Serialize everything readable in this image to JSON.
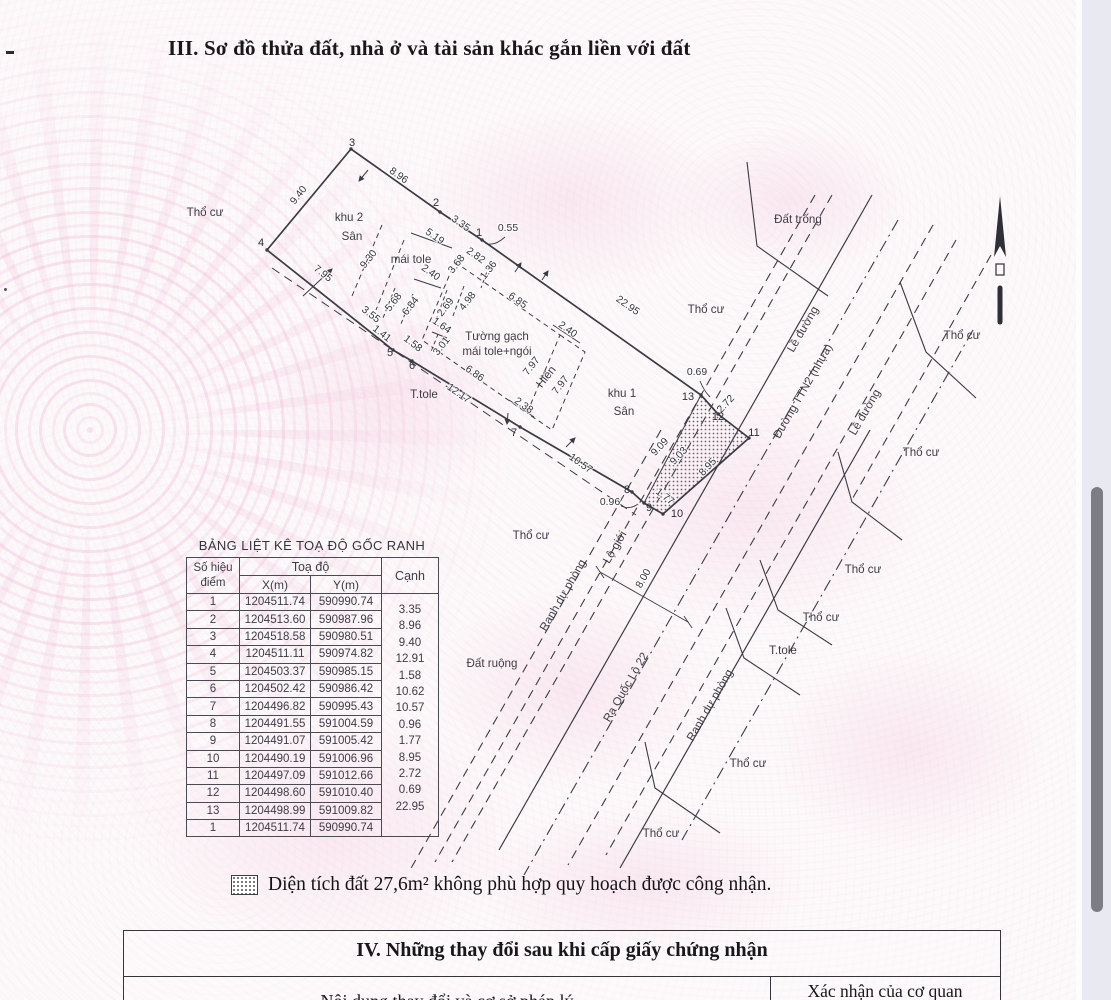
{
  "page": {
    "section3_title": "III. Sơ đồ thửa đất, nhà ở và tài sản khác gắn liền với đất",
    "legend_note": "Diện tích đất 27,6m² không phù hợp quy hoạch được công nhận.",
    "section4_title": "IV. Những thay đổi sau khi cấp giấy chứng nhận",
    "section4_col_left": "Nội dung thay đổi và cơ sở pháp lý",
    "section4_col_right": "Xác nhận của cơ quan"
  },
  "table": {
    "title": "BẢNG LIỆT KÊ TOẠ ĐỘ GỐC RANH",
    "col_point_l1": "Số hiệu",
    "col_point_l2": "điểm",
    "col_coord": "Toạ độ",
    "col_x": "X(m)",
    "col_y": "Y(m)",
    "col_edge": "Cạnh",
    "rows": [
      [
        "1",
        "1204511.74",
        "590990.74"
      ],
      [
        "2",
        "1204513.60",
        "590987.96"
      ],
      [
        "3",
        "1204518.58",
        "590980.51"
      ],
      [
        "4",
        "1204511.11",
        "590974.82"
      ],
      [
        "5",
        "1204503.37",
        "590985.15"
      ],
      [
        "6",
        "1204502.42",
        "590986.42"
      ],
      [
        "7",
        "1204496.82",
        "590995.43"
      ],
      [
        "8",
        "1204491.55",
        "591004.59"
      ],
      [
        "9",
        "1204491.07",
        "591005.42"
      ],
      [
        "10",
        "1204490.19",
        "591006.96"
      ],
      [
        "11",
        "1204497.09",
        "591012.66"
      ],
      [
        "12",
        "1204498.60",
        "591010.40"
      ],
      [
        "13",
        "1204498.99",
        "591009.82"
      ],
      [
        "1",
        "1204511.74",
        "590990.74"
      ]
    ],
    "edges": [
      "3.35",
      "8.96",
      "9.40",
      "12.91",
      "1.58",
      "10.62",
      "10.57",
      "0.96",
      "1.77",
      "8.95",
      "2.72",
      "0.69",
      "22.95"
    ]
  },
  "map": {
    "area_labels": [
      {
        "t": "Thổ cư",
        "x": 205,
        "y": 216
      },
      {
        "t": "khu 2",
        "x": 349,
        "y": 221
      },
      {
        "t": "Sân",
        "x": 352,
        "y": 240
      },
      {
        "t": "mái tole",
        "x": 411,
        "y": 263
      },
      {
        "t": "Tường gạch",
        "x": 497,
        "y": 340
      },
      {
        "t": "mái tole+ngói",
        "x": 497,
        "y": 355
      },
      {
        "t": "khu 1",
        "x": 622,
        "y": 397
      },
      {
        "t": "Sân",
        "x": 624,
        "y": 415
      },
      {
        "t": "T.tole",
        "x": 424,
        "y": 398
      },
      {
        "t": "Hiên",
        "x": 549,
        "y": 379,
        "r": -52
      },
      {
        "t": "Đất trống",
        "x": 798,
        "y": 223
      },
      {
        "t": "Thổ cư",
        "x": 706,
        "y": 313
      },
      {
        "t": "Thổ cư",
        "x": 962,
        "y": 339
      },
      {
        "t": "Thổ cư",
        "x": 921,
        "y": 456
      },
      {
        "t": "Thổ cư",
        "x": 863,
        "y": 573
      },
      {
        "t": "Thổ cư",
        "x": 821,
        "y": 621
      },
      {
        "t": "T.tole",
        "x": 783,
        "y": 654
      },
      {
        "t": "Thổ cư",
        "x": 748,
        "y": 767
      },
      {
        "t": "Thổ cư",
        "x": 661,
        "y": 837
      },
      {
        "t": "Thổ cư",
        "x": 531,
        "y": 539
      },
      {
        "t": "Đất ruộng",
        "x": 492,
        "y": 667
      },
      {
        "t": "Lề đường",
        "x": 806,
        "y": 331,
        "r": -60
      },
      {
        "t": "Lề đường",
        "x": 868,
        "y": 414,
        "r": -60
      },
      {
        "t": "Đường TTN2 (nhựa)",
        "x": 806,
        "y": 393,
        "r": -60
      },
      {
        "t": "Lộ giới",
        "x": 618,
        "y": 549,
        "r": -60
      },
      {
        "t": "Ranh dự phòng",
        "x": 566,
        "y": 597,
        "r": -60
      },
      {
        "t": "Ranh dự phòng",
        "x": 713,
        "y": 707,
        "r": -60
      },
      {
        "t": "Ra Quốc Lộ 22",
        "x": 629,
        "y": 689,
        "r": -60
      }
    ],
    "dim_labels": [
      {
        "t": "8.96",
        "x": 397,
        "y": 178,
        "r": 35
      },
      {
        "t": "3.35",
        "x": 459,
        "y": 226,
        "r": 35
      },
      {
        "t": "0.55",
        "x": 508,
        "y": 231
      },
      {
        "t": "9.40",
        "x": 301,
        "y": 197,
        "r": -52
      },
      {
        "t": "5.19",
        "x": 433,
        "y": 239,
        "r": 35
      },
      {
        "t": "9.30",
        "x": 371,
        "y": 261,
        "r": -52
      },
      {
        "t": "7.95",
        "x": 321,
        "y": 276,
        "r": 38
      },
      {
        "t": "2.40",
        "x": 429,
        "y": 275,
        "r": 35
      },
      {
        "t": "3.55",
        "x": 369,
        "y": 317,
        "r": 38
      },
      {
        "t": "1.41",
        "x": 380,
        "y": 336,
        "r": 38
      },
      {
        "t": "1.58",
        "x": 411,
        "y": 346,
        "r": 38
      },
      {
        "t": "5.68",
        "x": 396,
        "y": 304,
        "r": -52
      },
      {
        "t": "6.84",
        "x": 413,
        "y": 308,
        "r": -52
      },
      {
        "t": "2.69",
        "x": 448,
        "y": 309,
        "r": -52
      },
      {
        "t": "1.64",
        "x": 440,
        "y": 328,
        "r": 35
      },
      {
        "t": "3.01",
        "x": 444,
        "y": 348,
        "r": -52
      },
      {
        "t": "3.68",
        "x": 459,
        "y": 266,
        "r": -52
      },
      {
        "t": "2.82",
        "x": 474,
        "y": 258,
        "r": 35
      },
      {
        "t": "1.36",
        "x": 491,
        "y": 272,
        "r": -52
      },
      {
        "t": "4.98",
        "x": 470,
        "y": 303,
        "r": -52
      },
      {
        "t": "6.85",
        "x": 516,
        "y": 303,
        "r": 35
      },
      {
        "t": "22.95",
        "x": 626,
        "y": 308,
        "r": 35
      },
      {
        "t": "2.40",
        "x": 566,
        "y": 332,
        "r": 35
      },
      {
        "t": "7.97",
        "x": 534,
        "y": 368,
        "r": -52
      },
      {
        "t": "7.97",
        "x": 563,
        "y": 387,
        "r": -52
      },
      {
        "t": "2.38",
        "x": 522,
        "y": 408,
        "r": 35
      },
      {
        "t": "6.86",
        "x": 473,
        "y": 376,
        "r": 35
      },
      {
        "t": "12.17",
        "x": 457,
        "y": 396,
        "r": 35
      },
      {
        "t": "10.57",
        "x": 579,
        "y": 466,
        "r": 35
      },
      {
        "t": "0.96",
        "x": 610,
        "y": 505
      },
      {
        "t": "1.77",
        "x": 663,
        "y": 499,
        "r": 38
      },
      {
        "t": "8.95",
        "x": 710,
        "y": 469,
        "r": -47
      },
      {
        "t": "9.09",
        "x": 662,
        "y": 449,
        "r": -47
      },
      {
        "t": "9.03",
        "x": 681,
        "y": 458,
        "r": -47
      },
      {
        "t": "2.72",
        "x": 728,
        "y": 406,
        "r": -47
      },
      {
        "t": "0.69",
        "x": 697,
        "y": 375
      },
      {
        "t": "8.00",
        "x": 646,
        "y": 580,
        "r": -60
      }
    ],
    "point_labels": [
      {
        "t": "1",
        "x": 479,
        "y": 236
      },
      {
        "t": "2",
        "x": 436,
        "y": 206
      },
      {
        "t": "3",
        "x": 352,
        "y": 146
      },
      {
        "t": "4",
        "x": 261,
        "y": 246
      },
      {
        "t": "5",
        "x": 390,
        "y": 356
      },
      {
        "t": "6",
        "x": 412,
        "y": 369
      },
      {
        "t": "7",
        "x": 514,
        "y": 436
      },
      {
        "t": "8",
        "x": 627,
        "y": 493
      },
      {
        "t": "9",
        "x": 649,
        "y": 511
      },
      {
        "t": "10",
        "x": 677,
        "y": 517
      },
      {
        "t": "11",
        "x": 754,
        "y": 436
      },
      {
        "t": "12",
        "x": 718,
        "y": 420
      },
      {
        "t": "13",
        "x": 688,
        "y": 400
      }
    ]
  }
}
